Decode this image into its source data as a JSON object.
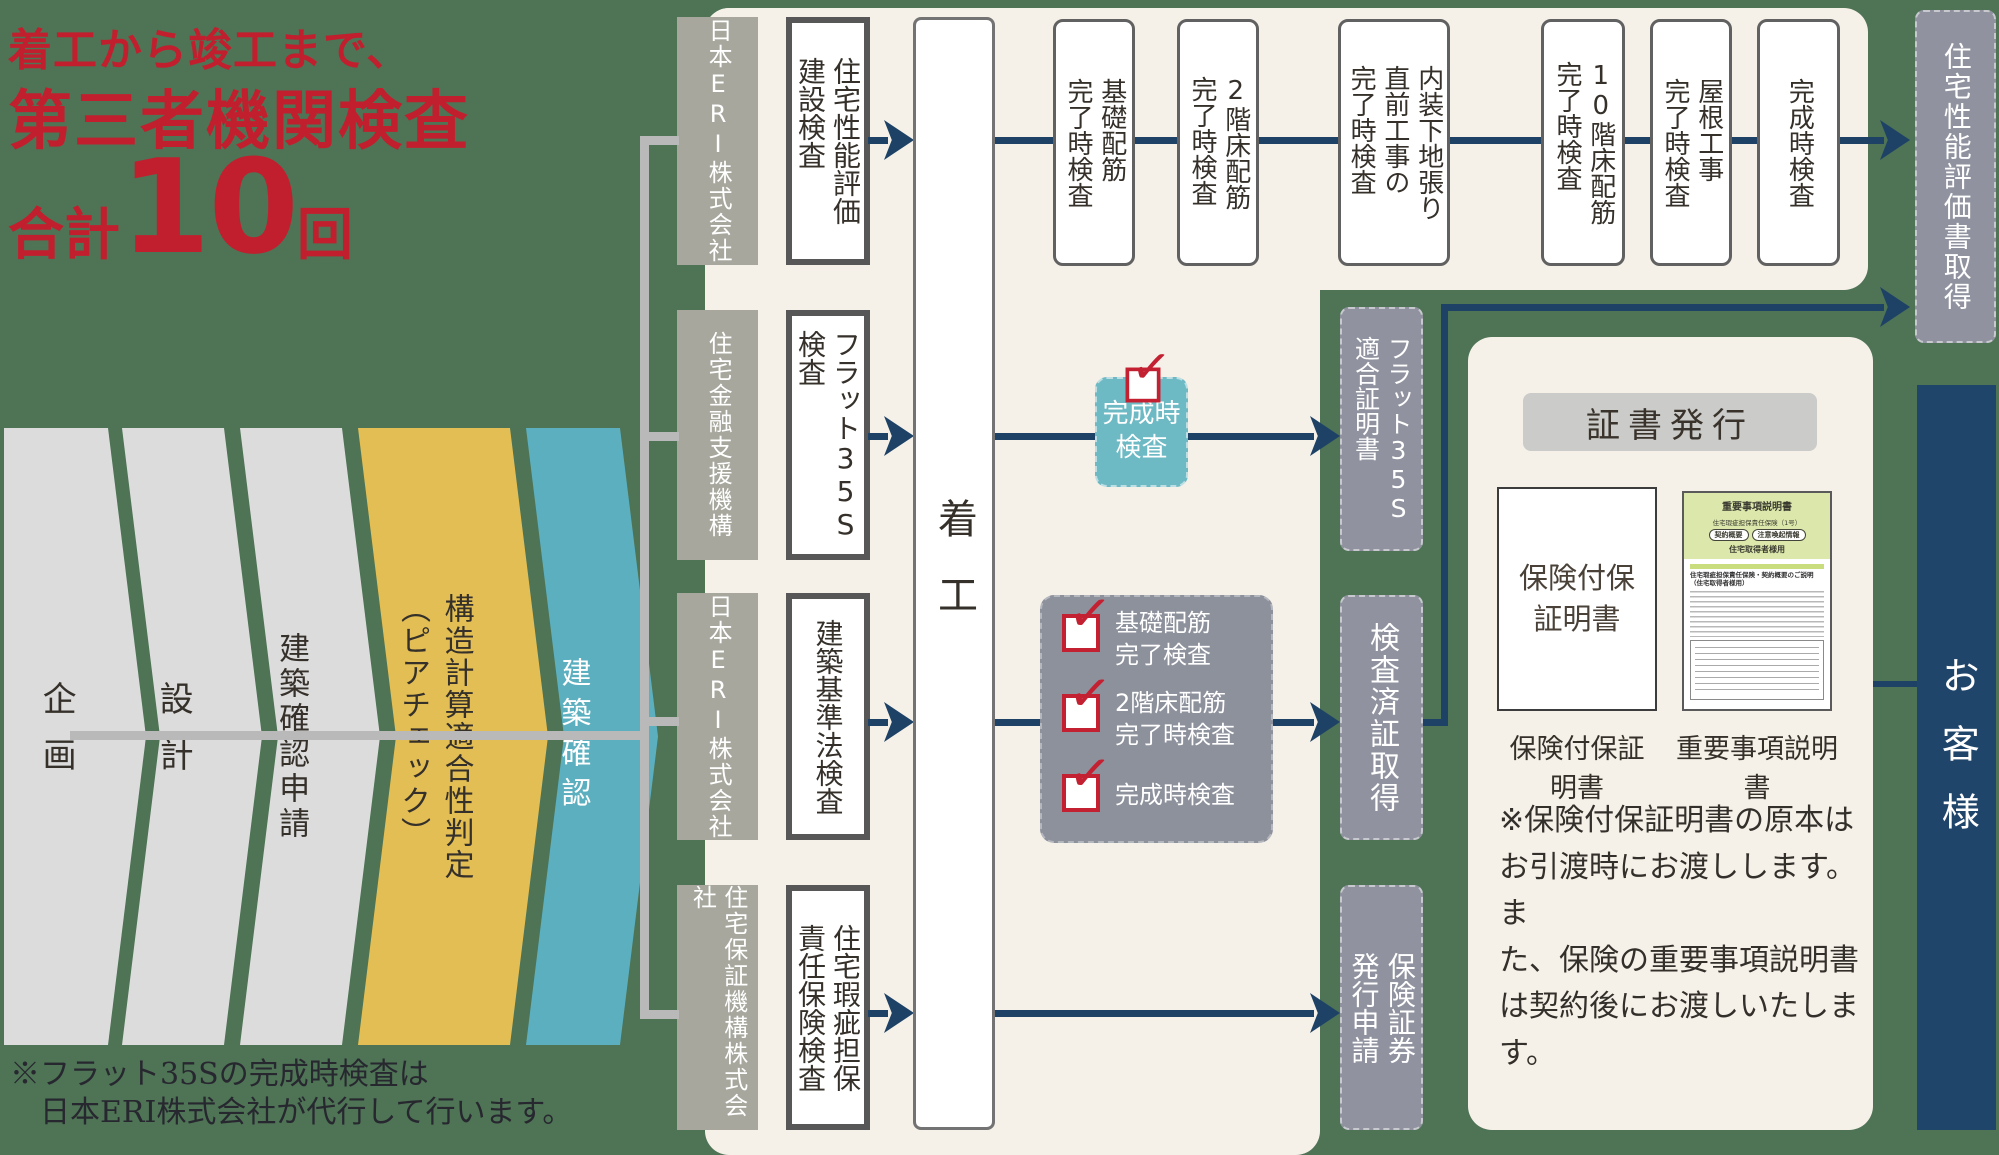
{
  "title": {
    "line1": "着工から竣工まで、",
    "line2": "第三者機関検査",
    "total_prefix": "合計",
    "total_number": "10",
    "total_suffix": "回"
  },
  "footnote": "※フラット35Sの完成時検査は\n　日本ERI株式会社が代行して行います。",
  "process_steps": [
    "企画",
    "設計",
    "建築確認申請",
    "構造計算適合性判定\n（ピアチェック）",
    "建築確認"
  ],
  "lanes": [
    {
      "agency": "日本ERI株式会社",
      "inspection": "住宅性能評価\n建設検査"
    },
    {
      "agency": "住宅金融支援機構",
      "inspection": "フラット35S\n検査"
    },
    {
      "agency": "日本ERI株式会社",
      "inspection": "建築基準法検査"
    },
    {
      "agency": "住宅保証機構株式会社",
      "inspection": "住宅瑕疵担保\n責任保険検査"
    }
  ],
  "construction_start": "着工",
  "timeline_boxes": [
    "基礎配筋\n完了時検査",
    "2階床配筋\n完了時検査",
    "内装下地張り\n直前工事の\n完了時検査",
    "10階床配筋\n完了時検査",
    "屋根工事\n完了時検査",
    "完成時検査"
  ],
  "flat35_check": "完成時\n検査",
  "checklist": [
    "基礎配筋\n完了検査",
    "2階床配筋\n完了時検査",
    "完成時検査"
  ],
  "outcomes": {
    "performance": "住宅性能評価書取得",
    "flat35_cert": "フラット35S\n適合証明書",
    "inspection_cert": "検査済証取得",
    "insurance_application": "保険証券\n発行申請"
  },
  "certificate_panel": {
    "header": "証書発行",
    "insurance_doc": "保険付保\n証明書",
    "caption_left": "保険付保証明書",
    "caption_right": "重要事項説明書",
    "thumb": {
      "title": "重要事項説明書",
      "subtitle": "住宅瑕疵担保責任保険（1号）",
      "badge1": "契約概要",
      "badge2": "注意喚起情報",
      "audience": "住宅取得者様用",
      "heading": "住宅瑕疵担保責任保険・契約概要のご説明（住宅取得者様用）"
    },
    "note": "※保険付保証明書の原本は\nお引渡時にお渡しします。ま\nた、保険の重要事項説明書\nは契約後にお渡しいたします。"
  },
  "customer": "お客様",
  "icons": {
    "check": "✓"
  },
  "colors": {
    "background": "#4e7355",
    "cream": "#f5f1e8",
    "navy": "#1e4266",
    "red": "#c21f2e",
    "teal": "#6db9c4",
    "yellow": "#e2be55",
    "gray_box": "#90939f",
    "header_gray": "#a7a79e"
  }
}
